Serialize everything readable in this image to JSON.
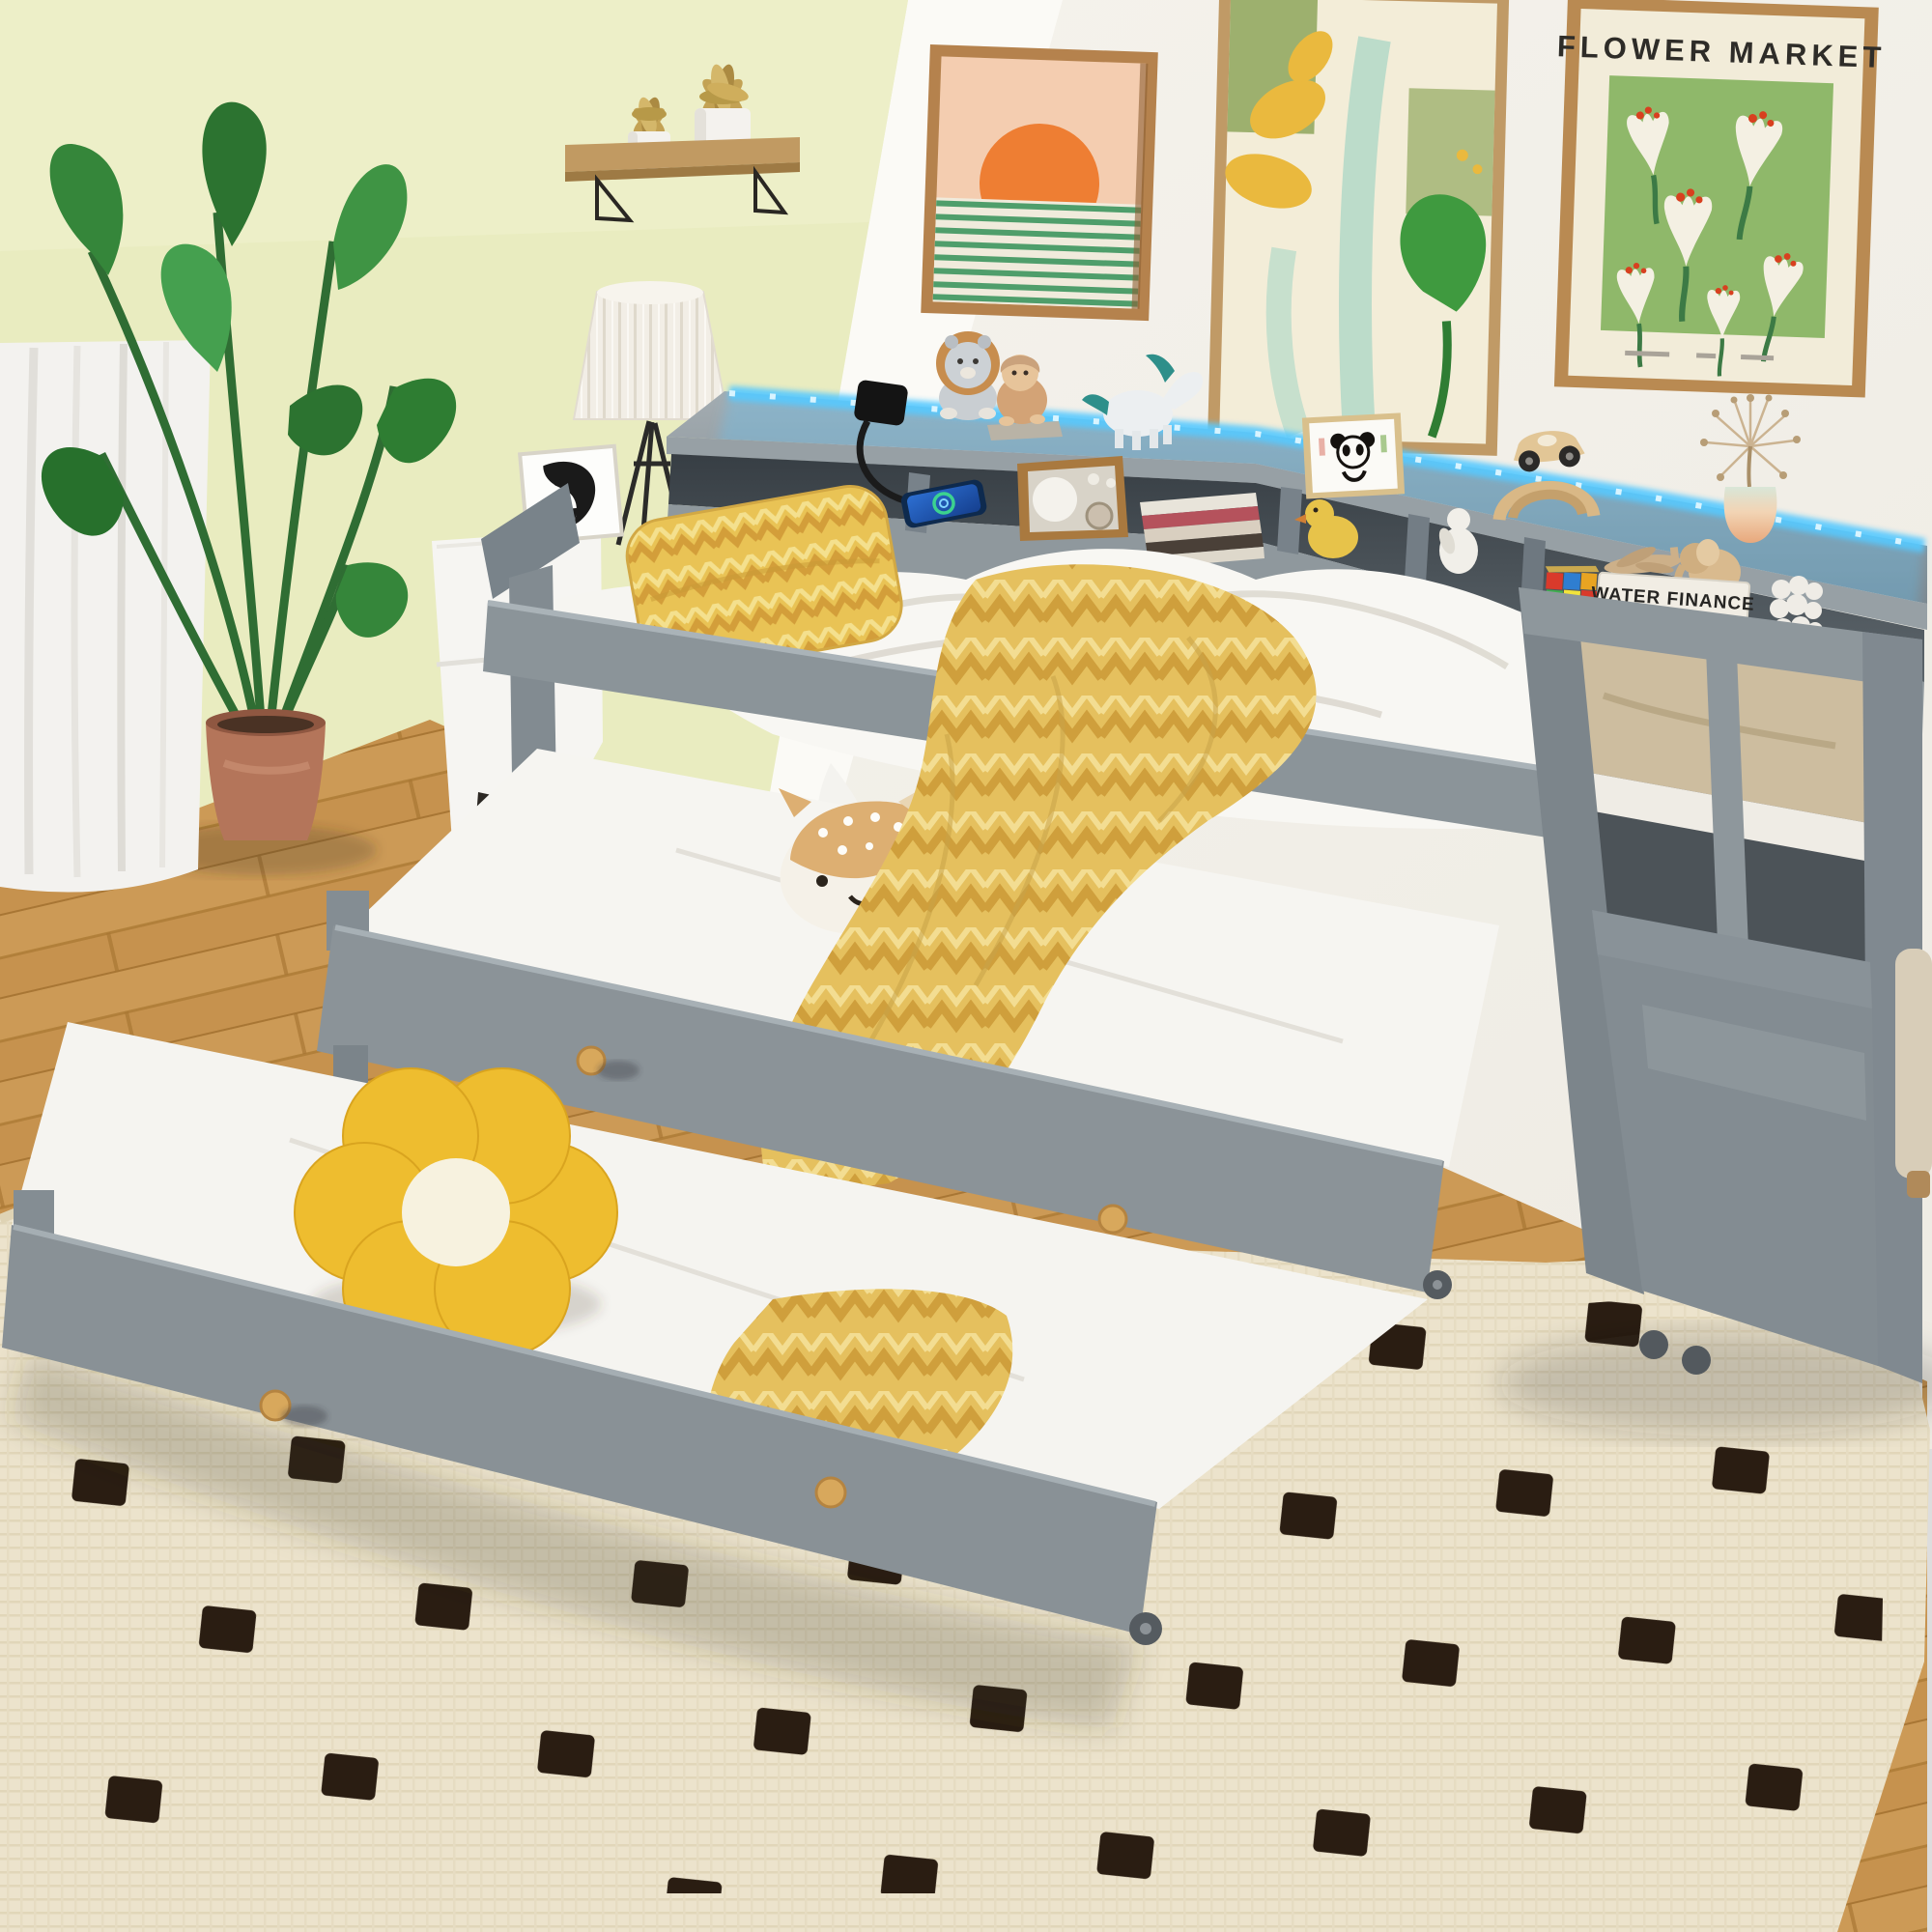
{
  "meta": {
    "type": "product-photograph",
    "scene": "Kids bedroom with a grey wood twin daybed that has a bookcase storage back, blue LED strip light and charging station, plus two pull-out trundle beds on casters, staged with plush toys on a cream rug"
  },
  "visible_text": {
    "poster_title": "FLOWER MARKET",
    "book_spine_title": "WATER FINANCE"
  },
  "palette": {
    "wall_left_yellow": "#e9ecc0",
    "wall_right_white": "#f3f1ea",
    "bed_grey": "#8e979c",
    "led_blue": "#4fc7ff",
    "floor_wood": "#c6924e",
    "rug_cream": "#ece3cc",
    "rug_dot": "#2a1d12",
    "bedding_white": "#f6f5f1",
    "accent_yellow": "#e9c355",
    "pot_terracotta": "#b4755a",
    "poster_green": "#8fb86a"
  },
  "objects": [
    {
      "id": "daybed",
      "label": "Grey twin daybed with bookcase storage back"
    },
    {
      "id": "led-strip",
      "label": "Blue LED strip light"
    },
    {
      "id": "charging-station",
      "label": "Charging hub with cable and smartphone"
    },
    {
      "id": "trundle-middle",
      "label": "First pull-out trundle bed"
    },
    {
      "id": "trundle-bottom",
      "label": "Second pull-out trundle bed"
    },
    {
      "id": "yellow-pillow",
      "label": "Yellow patterned pillow"
    },
    {
      "id": "yellow-blanket",
      "label": "Yellow patterned throw blanket"
    },
    {
      "id": "deer-plush",
      "label": "Plush deer pillow"
    },
    {
      "id": "teddy-bear",
      "label": "Grey knitted teddy bear"
    },
    {
      "id": "flower-pillow",
      "label": "Yellow flower plush pillow"
    },
    {
      "id": "lion-figurine",
      "label": "Lion plush figurine"
    },
    {
      "id": "bear-figurine",
      "label": "Hooded bear figurine"
    },
    {
      "id": "unicorn-figurine",
      "label": "White unicorn figurine"
    },
    {
      "id": "panda-picture",
      "label": "Framed panda drawing"
    },
    {
      "id": "toy-car-arch",
      "label": "Wooden toy car on arch"
    },
    {
      "id": "dandelion-vase",
      "label": "Dried dandelion in gradient vase"
    },
    {
      "id": "radio",
      "label": "Vintage wooden radio"
    },
    {
      "id": "magazines",
      "label": "Stack of magazines"
    },
    {
      "id": "rubiks-cube",
      "label": "Rubik's cube"
    },
    {
      "id": "book-stack",
      "label": "Stacked books"
    },
    {
      "id": "toy-airplane",
      "label": "Wooden toy airplane"
    },
    {
      "id": "elephant-figurine",
      "label": "Wooden elephant figurine"
    },
    {
      "id": "bubble-sculpture",
      "label": "White bubble sculpture"
    },
    {
      "id": "duck-figurine",
      "label": "Yellow duckling figurine"
    },
    {
      "id": "white-figurine",
      "label": "Small white figurine"
    },
    {
      "id": "sunrise-art",
      "label": "Framed sunrise art print"
    },
    {
      "id": "botanical-art",
      "label": "Framed botanical art print"
    },
    {
      "id": "flower-market-poster",
      "label": "Flower Market framed poster"
    },
    {
      "id": "portrait-print",
      "label": "Black and white portrait print"
    },
    {
      "id": "wall-shelf",
      "label": "Wooden wall shelf with potted plants"
    },
    {
      "id": "table-lamp",
      "label": "White pleated table lamp"
    },
    {
      "id": "nightstand",
      "label": "White nightstand"
    },
    {
      "id": "tall-plant",
      "label": "Potted banana-leaf plant"
    },
    {
      "id": "curtain",
      "label": "White curtain"
    },
    {
      "id": "rug",
      "label": "Cream rug with black woven squares"
    },
    {
      "id": "wood-floor",
      "label": "Light wood floor"
    }
  ]
}
